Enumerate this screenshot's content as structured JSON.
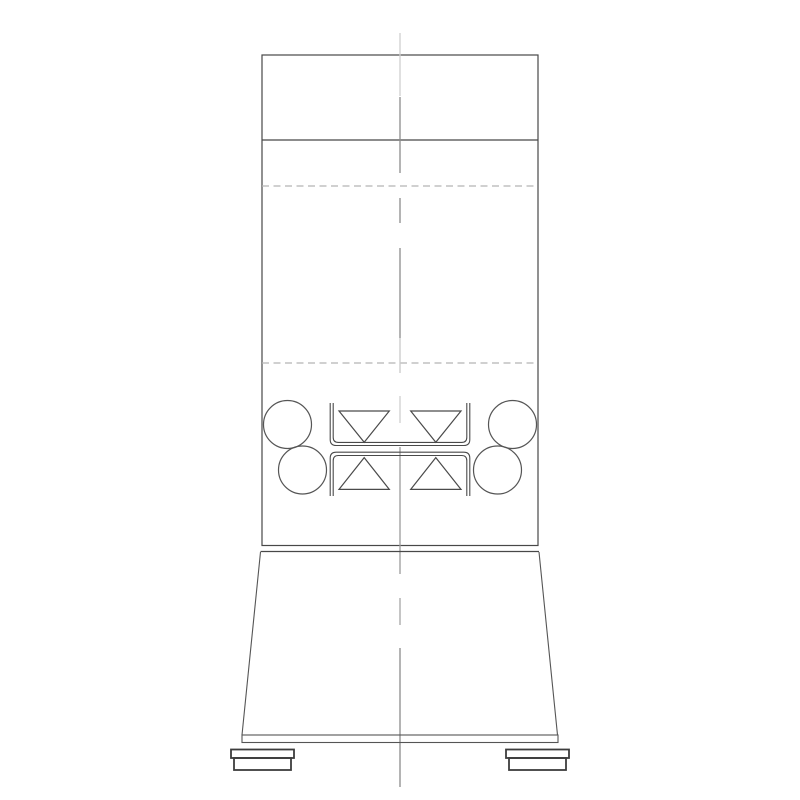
{
  "app": {
    "background": "#ffffff",
    "description": "technical-elevation-drawing"
  },
  "colors": {
    "line_dark": "#484848",
    "line_feet": "#3d3d3d",
    "centerline_dark": "#8c8c8c",
    "centerline_light": "#cfcfcf",
    "dashed_section": "#b5b5b5"
  },
  "drawing": {
    "viewBox": "0 0 800 800",
    "shapes": [
      {
        "name": "column-body-outline",
        "type": "rect",
        "attrs": {
          "x": 262,
          "y": 55,
          "width": 276,
          "height": 490.5,
          "fill": "none",
          "stroke": "#484848",
          "stroke-width": 1.2
        }
      },
      {
        "name": "column-head-divider-line",
        "type": "line",
        "attrs": {
          "x1": 262,
          "y1": 140,
          "x2": 538,
          "y2": 140,
          "stroke": "#484848",
          "stroke-width": 1.2
        }
      },
      {
        "name": "upper-section-dashed-line",
        "type": "line",
        "attrs": {
          "x1": 262,
          "y1": 186,
          "x2": 538,
          "y2": 186,
          "stroke": "#b5b5b5",
          "stroke-width": 1.2,
          "stroke-dasharray": "7 4.5"
        }
      },
      {
        "name": "lower-section-dashed-line",
        "type": "line",
        "attrs": {
          "x1": 262,
          "y1": 363,
          "x2": 538,
          "y2": 363,
          "stroke": "#b5b5b5",
          "stroke-width": 1.2,
          "stroke-dasharray": "7 4.5"
        }
      },
      {
        "name": "centerline-segment-top-light",
        "type": "line",
        "attrs": {
          "x1": 400,
          "y1": 33,
          "x2": 400,
          "y2": 96,
          "stroke": "#cfcfcf",
          "stroke-width": 1.3
        }
      },
      {
        "name": "centerline-segment-head",
        "type": "line",
        "attrs": {
          "x1": 400,
          "y1": 97,
          "x2": 400,
          "y2": 173,
          "stroke": "#8c8c8c",
          "stroke-width": 1.3
        }
      },
      {
        "name": "centerline-short-dash-upper",
        "type": "line",
        "attrs": {
          "x1": 400,
          "y1": 198,
          "x2": 400,
          "y2": 223,
          "stroke": "#8c8c8c",
          "stroke-width": 1.3
        }
      },
      {
        "name": "centerline-segment-mid",
        "type": "line",
        "attrs": {
          "x1": 400,
          "y1": 248,
          "x2": 400,
          "y2": 338,
          "stroke": "#8c8c8c",
          "stroke-width": 1.3
        }
      },
      {
        "name": "centerline-segment-mid-light",
        "type": "line",
        "attrs": {
          "x1": 400,
          "y1": 338,
          "x2": 400,
          "y2": 373,
          "stroke": "#c9c9c9",
          "stroke-width": 1.3
        }
      },
      {
        "name": "centerline-segment-roller-zone-light",
        "type": "line",
        "attrs": {
          "x1": 400,
          "y1": 396,
          "x2": 400,
          "y2": 423,
          "stroke": "#cfcfcf",
          "stroke-width": 1.3
        }
      },
      {
        "name": "centerline-segment-lower",
        "type": "line",
        "attrs": {
          "x1": 400,
          "y1": 447,
          "x2": 400,
          "y2": 574,
          "stroke": "#9a9a9a",
          "stroke-width": 1.3
        }
      },
      {
        "name": "centerline-short-dash-hopper",
        "type": "line",
        "attrs": {
          "x1": 400,
          "y1": 598,
          "x2": 400,
          "y2": 625,
          "stroke": "#a6a6a6",
          "stroke-width": 1.3
        }
      },
      {
        "name": "centerline-segment-base",
        "type": "line",
        "attrs": {
          "x1": 400,
          "y1": 648,
          "x2": 400,
          "y2": 787,
          "stroke": "#8c8c8c",
          "stroke-width": 1.3
        }
      },
      {
        "name": "roller-circle-upper-left",
        "type": "circle",
        "attrs": {
          "cx": 287.5,
          "cy": 424.5,
          "r": 24,
          "fill": "none",
          "stroke": "#555555",
          "stroke-width": 1.2
        }
      },
      {
        "name": "roller-circle-lower-left",
        "type": "circle",
        "attrs": {
          "cx": 302.5,
          "cy": 470,
          "r": 24,
          "fill": "none",
          "stroke": "#555555",
          "stroke-width": 1.2
        }
      },
      {
        "name": "roller-circle-upper-right",
        "type": "circle",
        "attrs": {
          "cx": 512.5,
          "cy": 424.5,
          "r": 24,
          "fill": "none",
          "stroke": "#555555",
          "stroke-width": 1.2
        }
      },
      {
        "name": "roller-circle-lower-right",
        "type": "circle",
        "attrs": {
          "cx": 497.5,
          "cy": 470,
          "r": 24,
          "fill": "none",
          "stroke": "#555555",
          "stroke-width": 1.2
        }
      },
      {
        "name": "upper-channel-outer-profile",
        "type": "path",
        "attrs": {
          "d": "M 330.2 403 L 330.2 439.5 Q 330.2 445.5 336.2 445.5 L 463.8 445.5 Q 469.8 445.5 469.8 439.5 L 469.8 403",
          "fill": "none",
          "stroke": "#4a4a4a",
          "stroke-width": 1.1
        }
      },
      {
        "name": "upper-channel-inner-profile",
        "type": "path",
        "attrs": {
          "d": "M 333.2 403 L 333.2 437.2 Q 333.2 442.4 338.4 442.4 L 461.6 442.4 Q 466.8 442.4 466.8 437.2 L 466.8 403",
          "fill": "none",
          "stroke": "#4a4a4a",
          "stroke-width": 1.1
        }
      },
      {
        "name": "lower-channel-outer-profile",
        "type": "path",
        "attrs": {
          "d": "M 330.2 496 L 330.2 458.2 Q 330.2 452.2 336.2 452.2 L 463.8 452.2 Q 469.8 452.2 469.8 458.2 L 469.8 496",
          "fill": "none",
          "stroke": "#4a4a4a",
          "stroke-width": 1.1
        }
      },
      {
        "name": "lower-channel-inner-profile",
        "type": "path",
        "attrs": {
          "d": "M 333.2 496 L 333.2 460.7 Q 333.2 455.5 338.4 455.5 L 461.6 455.5 Q 466.8 455.5 466.8 460.7 L 466.8 496",
          "fill": "none",
          "stroke": "#4a4a4a",
          "stroke-width": 1.1
        }
      },
      {
        "name": "flow-triangle-upper-left",
        "type": "polygon",
        "attrs": {
          "points": "339,411 389.3,411 364.2,442.3",
          "fill": "none",
          "stroke": "#4a4a4a",
          "stroke-width": 1.2
        }
      },
      {
        "name": "flow-triangle-upper-right",
        "type": "polygon",
        "attrs": {
          "points": "410.7,411 461,411 435.8,442.3",
          "fill": "none",
          "stroke": "#4a4a4a",
          "stroke-width": 1.2
        }
      },
      {
        "name": "flow-triangle-lower-left",
        "type": "polygon",
        "attrs": {
          "points": "364.2,457.6 389.3,489.4 339,489.4",
          "fill": "none",
          "stroke": "#4a4a4a",
          "stroke-width": 1.2
        }
      },
      {
        "name": "flow-triangle-lower-right",
        "type": "polygon",
        "attrs": {
          "points": "435.8,457.6 461,489.4 410.7,489.4",
          "fill": "none",
          "stroke": "#4a4a4a",
          "stroke-width": 1.2
        }
      },
      {
        "name": "hopper-top-edge-line",
        "type": "line",
        "attrs": {
          "x1": 260.5,
          "y1": 551.5,
          "x2": 539,
          "y2": 551.5,
          "stroke": "#484848",
          "stroke-width": 1.2
        }
      },
      {
        "name": "hopper-left-slant-edge",
        "type": "line",
        "attrs": {
          "x1": 260.5,
          "y1": 552,
          "x2": 242,
          "y2": 735,
          "stroke": "#555555",
          "stroke-width": 1.1
        }
      },
      {
        "name": "hopper-right-slant-edge",
        "type": "line",
        "attrs": {
          "x1": 539,
          "y1": 552,
          "x2": 557.5,
          "y2": 735,
          "stroke": "#555555",
          "stroke-width": 1.1
        }
      },
      {
        "name": "base-plate-outline",
        "type": "rect",
        "attrs": {
          "x": 242,
          "y": 735,
          "width": 316,
          "height": 7.5,
          "fill": "none",
          "stroke": "#555555",
          "stroke-width": 1.1
        }
      },
      {
        "name": "left-foot-top-plate",
        "type": "rect",
        "attrs": {
          "x": 231,
          "y": 749.5,
          "width": 63,
          "height": 8.5,
          "fill": "none",
          "stroke": "#3d3d3d",
          "stroke-width": 1.8
        }
      },
      {
        "name": "left-foot-block",
        "type": "rect",
        "attrs": {
          "x": 234,
          "y": 758,
          "width": 57,
          "height": 12,
          "fill": "none",
          "stroke": "#3d3d3d",
          "stroke-width": 1.8
        }
      },
      {
        "name": "right-foot-top-plate",
        "type": "rect",
        "attrs": {
          "x": 506,
          "y": 749.5,
          "width": 63,
          "height": 8.5,
          "fill": "none",
          "stroke": "#3d3d3d",
          "stroke-width": 1.8
        }
      },
      {
        "name": "right-foot-block",
        "type": "rect",
        "attrs": {
          "x": 509,
          "y": 758,
          "width": 57,
          "height": 12,
          "fill": "none",
          "stroke": "#3d3d3d",
          "stroke-width": 1.8
        }
      }
    ]
  }
}
